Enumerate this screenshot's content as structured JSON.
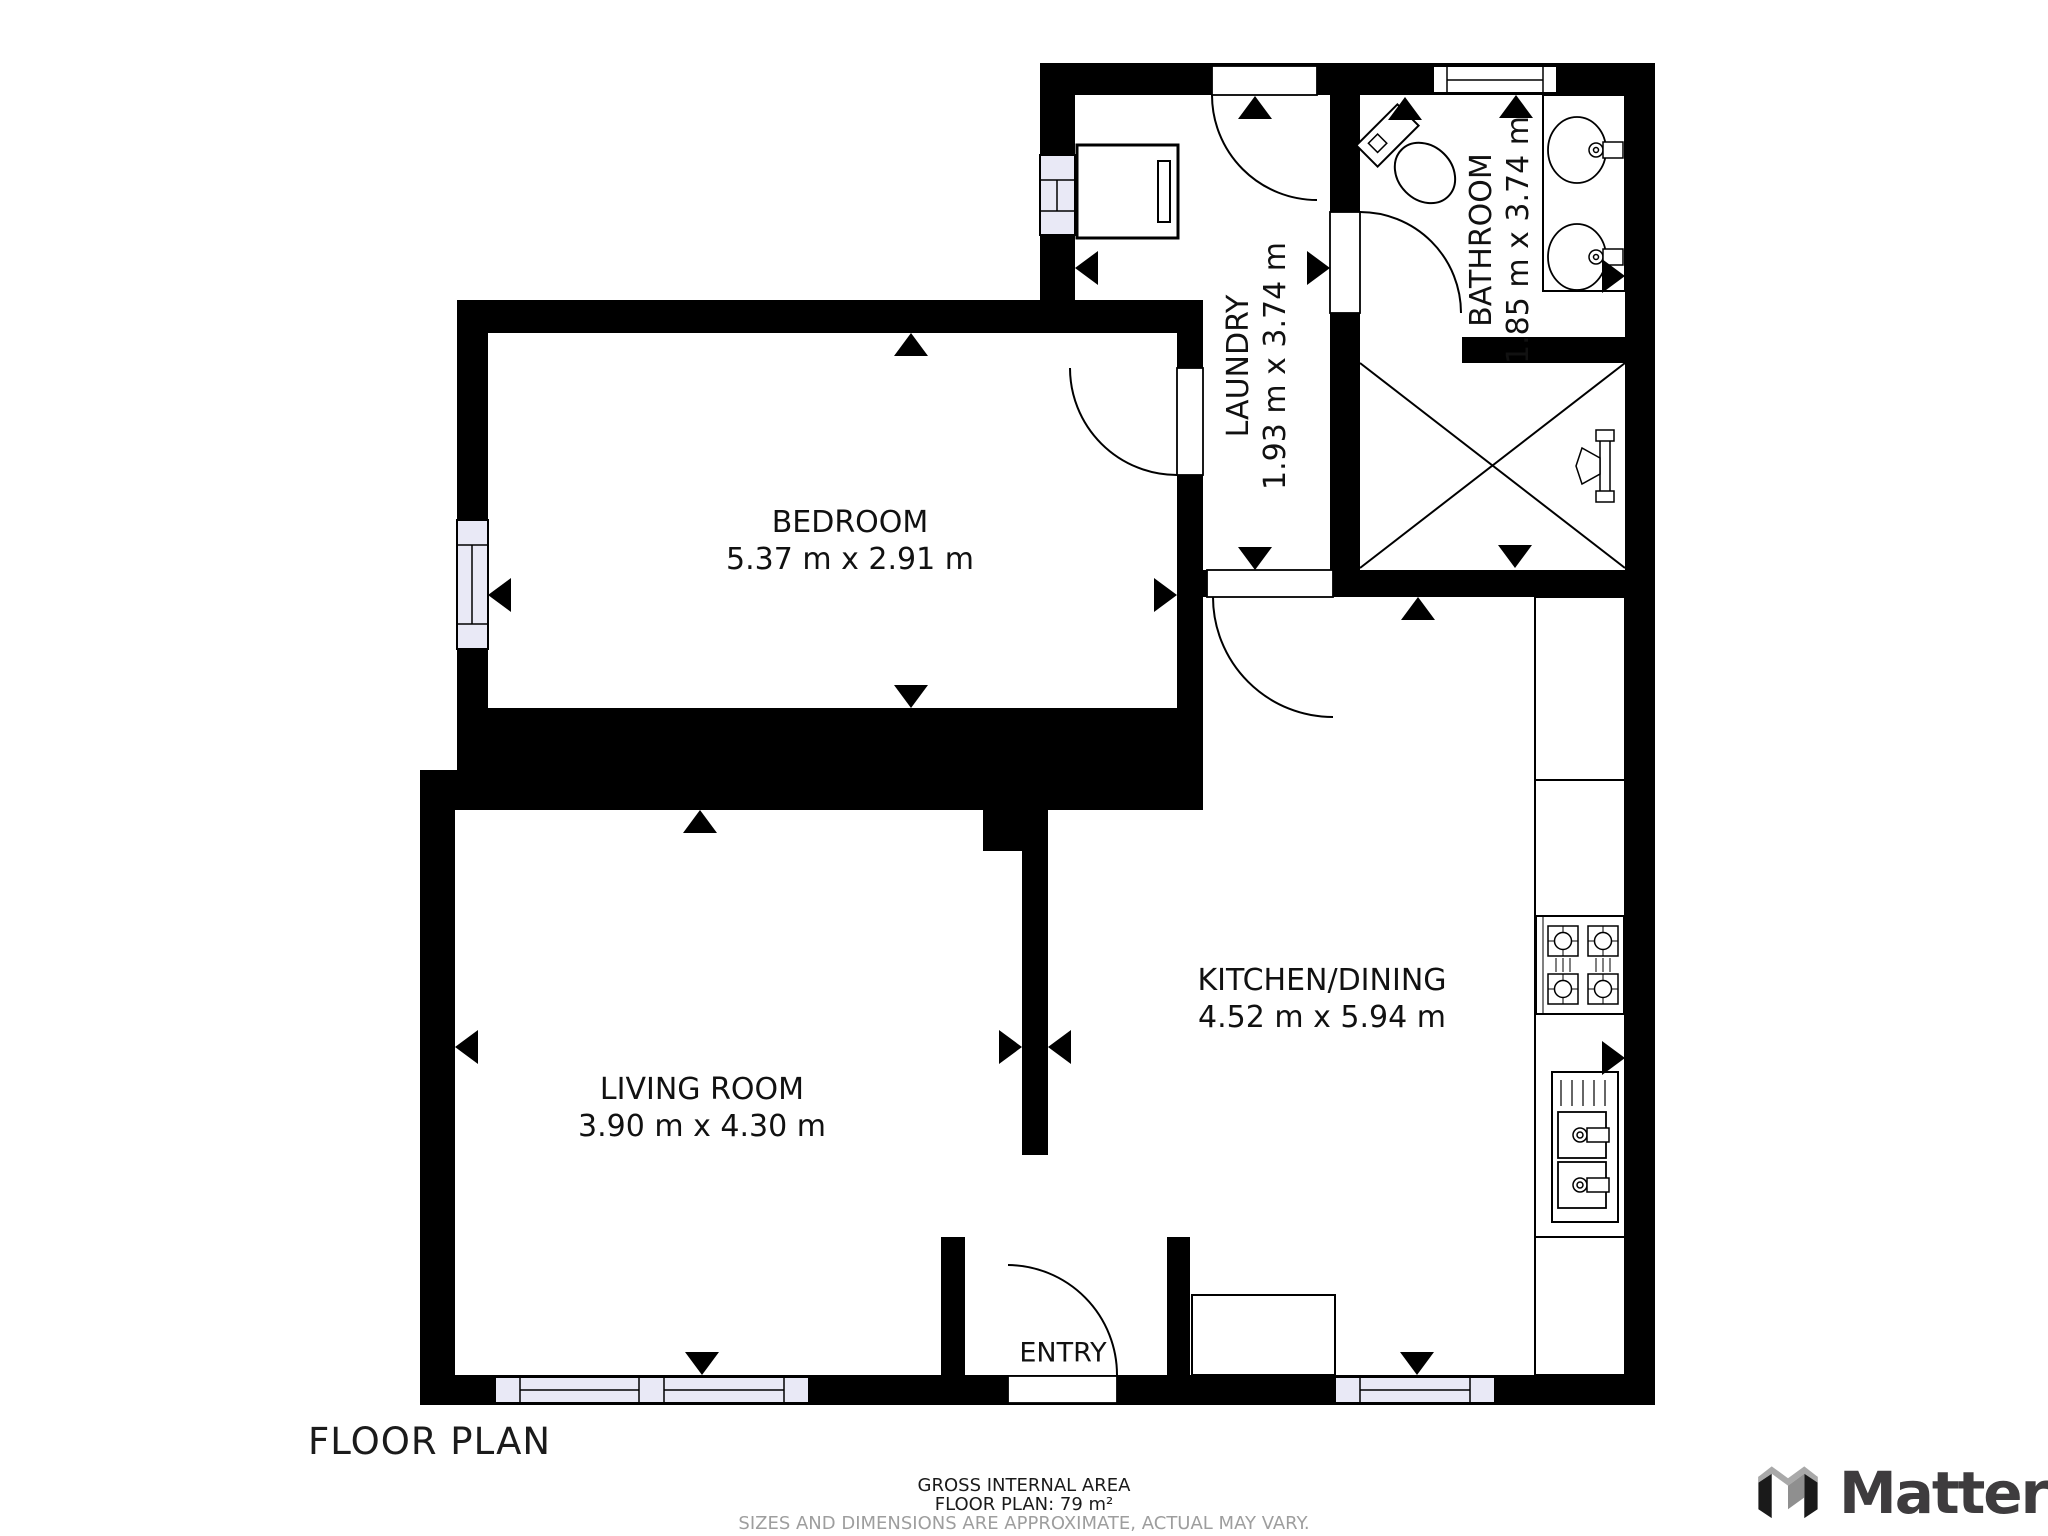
{
  "page": {
    "title": "FLOOR PLAN"
  },
  "rooms": {
    "bedroom": {
      "name": "BEDROOM",
      "dims": "5.37 m x 2.91 m"
    },
    "laundry": {
      "name": "LAUNDRY",
      "dims": "1.93 m x 3.74 m"
    },
    "bathroom": {
      "name": "BATHROOM",
      "dims": "1.85 m x 3.74 m"
    },
    "kitchen": {
      "name": "KITCHEN/DINING",
      "dims": "4.52 m x 5.94 m"
    },
    "living": {
      "name": "LIVING ROOM",
      "dims": "3.90 m x 4.30 m"
    },
    "entry": {
      "name": "ENTRY"
    }
  },
  "footer": {
    "line1": "GROSS INTERNAL AREA",
    "line2": "FLOOR PLAN: 79 m²",
    "line3": "SIZES AND DIMENSIONS ARE APPROXIMATE, ACTUAL MAY VARY."
  },
  "brand": {
    "wordmark": "Matterpo"
  },
  "colors": {
    "wall": "#000000",
    "floor": "#ffffff",
    "window_fill": "#e9e9f6",
    "text": "#111111",
    "footer_muted": "#9e9e9e",
    "brand_text": "#3e3c3e",
    "brand_gray_light": "#a9a9a9",
    "brand_gray_mid": "#8f8f8f"
  },
  "fixtures": [
    "washer",
    "toilet",
    "vanity-sinks",
    "shower",
    "cooktop",
    "kitchen-sink",
    "counter",
    "entry-cabinet"
  ]
}
